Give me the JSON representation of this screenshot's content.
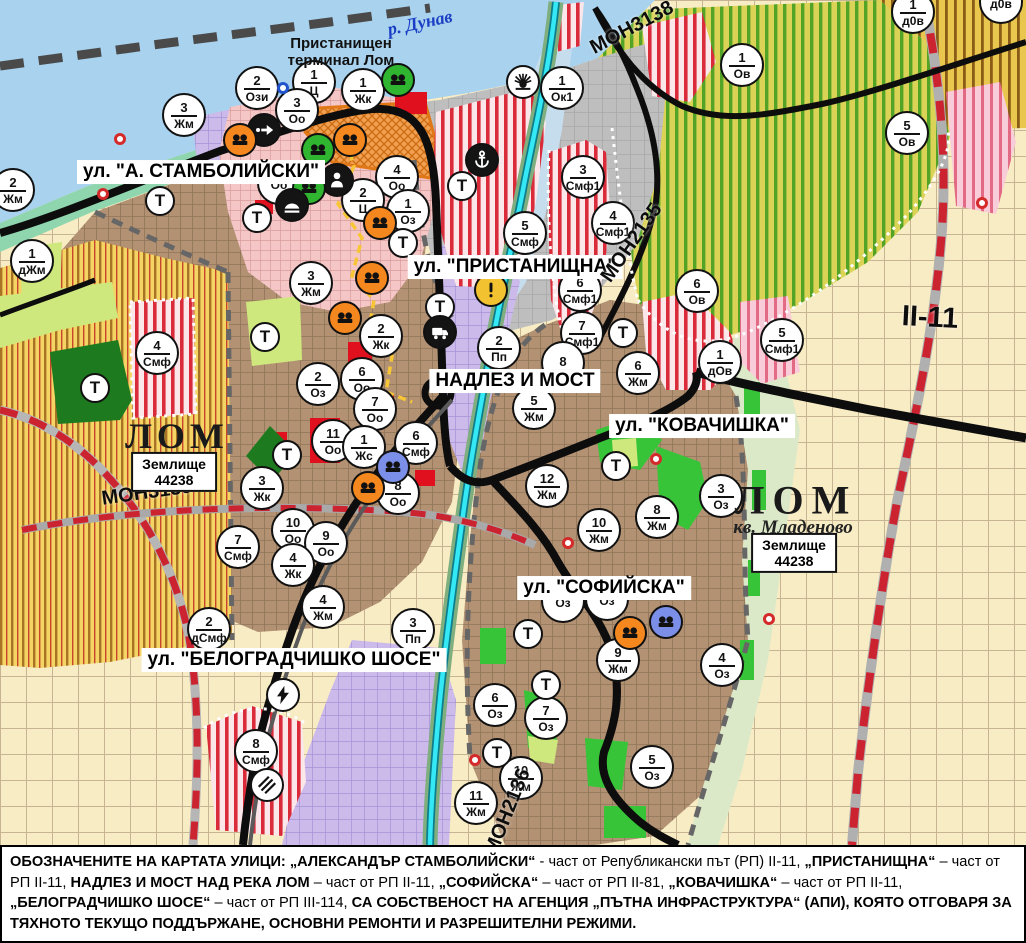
{
  "colors": {
    "orange": "#f5871f",
    "green": "#2fb52f",
    "blue": "#7c8fe8",
    "yellow": "#f2c230",
    "black": "#141414",
    "white": "#ffffff",
    "marker_border": "#111111",
    "red_dot": "#d42a2a",
    "blue_ring": "#2255cc"
  },
  "map": {
    "t_label": "Т",
    "street_labels": [
      {
        "text": "ул. \"А. СТАМБОЛИЙСКИ\"",
        "x": 201,
        "y": 172
      },
      {
        "text": "ул. \"ПРИСТАНИЩНА\"",
        "x": 515,
        "y": 267
      },
      {
        "text": "НАДЛЕЗ И МОСТ",
        "x": 515,
        "y": 381
      },
      {
        "text": "ул. \"КОВАЧИШКА\"",
        "x": 702,
        "y": 426
      },
      {
        "text": "ул. \"СОФИЙСКА\"",
        "x": 604,
        "y": 588
      },
      {
        "text": "ул. \"БЕЛОГРАДЧИШКО ШОСЕ\"",
        "x": 294,
        "y": 660
      }
    ],
    "road_labels": [
      {
        "text": "МОН3139",
        "x": 147,
        "y": 493,
        "rot": -8,
        "size": 20
      },
      {
        "text": "МОН3138",
        "x": 632,
        "y": 28,
        "rot": -28,
        "size": 20
      },
      {
        "text": "МОН2135",
        "x": 632,
        "y": 243,
        "rot": -55,
        "size": 20
      },
      {
        "text": "МОН2136",
        "x": 508,
        "y": 812,
        "rot": -68,
        "size": 20
      },
      {
        "text": "II-11",
        "x": 930,
        "y": 318,
        "rot": 3,
        "size": 29
      }
    ],
    "area_labels": [
      {
        "style": "city",
        "text": "ЛОМ",
        "x": 177,
        "y": 436,
        "size": 36,
        "ls": 5
      },
      {
        "style": "box",
        "text": "Землище\n44238",
        "x": 174,
        "y": 472
      },
      {
        "style": "city",
        "text": "ЛОМ",
        "x": 796,
        "y": 500,
        "size": 40,
        "ls": 8
      },
      {
        "style": "italic",
        "text": "кв. Младеново",
        "x": 793,
        "y": 528,
        "size": 19
      },
      {
        "style": "box",
        "text": "Землище\n44238",
        "x": 794,
        "y": 553
      },
      {
        "style": "river",
        "text": "р. Дунав",
        "x": 420,
        "y": 23
      },
      {
        "style": "port",
        "text": "Пристанищен\nтерминал Лом",
        "x": 341,
        "y": 52
      }
    ],
    "markers": [
      {
        "n": "2",
        "c": "Ози",
        "x": 257,
        "y": 88
      },
      {
        "n": "1",
        "c": "Ц",
        "x": 314,
        "y": 82
      },
      {
        "n": "1",
        "c": "Жк",
        "x": 363,
        "y": 90
      },
      {
        "n": "3",
        "c": "Оо",
        "x": 297,
        "y": 110
      },
      {
        "n": "1",
        "c": "Ок1",
        "x": 562,
        "y": 88
      },
      {
        "n": "3",
        "c": "Жм",
        "x": 184,
        "y": 115
      },
      {
        "n": "",
        "c": "Оо",
        "x": 279,
        "y": 183
      },
      {
        "n": "4",
        "c": "Оо",
        "x": 397,
        "y": 177
      },
      {
        "n": "2",
        "c": "Ц",
        "x": 363,
        "y": 200
      },
      {
        "n": "1",
        "c": "Оз",
        "x": 408,
        "y": 211
      },
      {
        "n": "1",
        "c": "дЖм",
        "x": 32,
        "y": 261
      },
      {
        "n": "2",
        "c": "Жм",
        "x": 13,
        "y": 190
      },
      {
        "n": "3",
        "c": "Жм",
        "x": 311,
        "y": 283
      },
      {
        "n": "2",
        "c": "Жк",
        "x": 381,
        "y": 336
      },
      {
        "n": "6",
        "c": "Оо",
        "x": 362,
        "y": 379
      },
      {
        "n": "2",
        "c": "Оз",
        "x": 318,
        "y": 384
      },
      {
        "n": "7",
        "c": "Оо",
        "x": 375,
        "y": 409
      },
      {
        "n": "11",
        "c": "Оо",
        "x": 333,
        "y": 441
      },
      {
        "n": "1",
        "c": "Жс",
        "x": 364,
        "y": 447
      },
      {
        "n": "6",
        "c": "Смф",
        "x": 416,
        "y": 443
      },
      {
        "n": "8",
        "c": "Оо",
        "x": 398,
        "y": 493
      },
      {
        "n": "3",
        "c": "Жк",
        "x": 262,
        "y": 488
      },
      {
        "n": "10",
        "c": "Оо",
        "x": 293,
        "y": 530
      },
      {
        "n": "9",
        "c": "Оо",
        "x": 326,
        "y": 543
      },
      {
        "n": "4",
        "c": "Жк",
        "x": 293,
        "y": 565
      },
      {
        "n": "7",
        "c": "Смф",
        "x": 238,
        "y": 547
      },
      {
        "n": "4",
        "c": "Смф",
        "x": 157,
        "y": 353
      },
      {
        "n": "2",
        "c": "дСмф",
        "x": 209,
        "y": 629
      },
      {
        "n": "4",
        "c": "Жм",
        "x": 323,
        "y": 607
      },
      {
        "n": "3",
        "c": "Пп",
        "x": 413,
        "y": 630
      },
      {
        "n": "8",
        "c": "Смф",
        "x": 256,
        "y": 751
      },
      {
        "n": "2",
        "c": "Пп",
        "x": 499,
        "y": 348
      },
      {
        "n": "5",
        "c": "Смф",
        "x": 525,
        "y": 233
      },
      {
        "n": "3",
        "c": "Смф1",
        "x": 583,
        "y": 177
      },
      {
        "n": "4",
        "c": "Смф1",
        "x": 613,
        "y": 223
      },
      {
        "n": "6",
        "c": "Смф1",
        "x": 580,
        "y": 290
      },
      {
        "n": "7",
        "c": "Смф1",
        "x": 582,
        "y": 333
      },
      {
        "n": "8",
        "c": "",
        "x": 563,
        "y": 363
      },
      {
        "n": "5",
        "c": "Жм",
        "x": 534,
        "y": 408
      },
      {
        "n": "6",
        "c": "Жм",
        "x": 638,
        "y": 373
      },
      {
        "n": "12",
        "c": "Жм",
        "x": 547,
        "y": 486
      },
      {
        "n": "10",
        "c": "Жм",
        "x": 599,
        "y": 530
      },
      {
        "n": "8",
        "c": "Жм",
        "x": 657,
        "y": 517
      },
      {
        "n": "3",
        "c": "Оз",
        "x": 721,
        "y": 496
      },
      {
        "n": "1",
        "c": "дОв",
        "x": 720,
        "y": 362
      },
      {
        "n": "5",
        "c": "Смф1",
        "x": 782,
        "y": 340
      },
      {
        "n": "6",
        "c": "Ов",
        "x": 697,
        "y": 291
      },
      {
        "n": "1",
        "c": "Ов",
        "x": 742,
        "y": 65
      },
      {
        "n": "5",
        "c": "Ов",
        "x": 907,
        "y": 133
      },
      {
        "n": "1",
        "c": "д0в",
        "x": 913,
        "y": 12
      },
      {
        "n": "",
        "c": "д0в",
        "x": 1001,
        "y": 2
      },
      {
        "n": "9",
        "c": "Жм",
        "x": 618,
        "y": 660
      },
      {
        "n": "4",
        "c": "Оз",
        "x": 722,
        "y": 665
      },
      {
        "n": "6",
        "c": "Оз",
        "x": 495,
        "y": 705
      },
      {
        "n": "7",
        "c": "Оз",
        "x": 546,
        "y": 718
      },
      {
        "n": "5",
        "c": "Оз",
        "x": 652,
        "y": 767
      },
      {
        "n": "10",
        "c": "Жм",
        "x": 521,
        "y": 778
      },
      {
        "n": "11",
        "c": "Жм",
        "x": 476,
        "y": 803
      },
      {
        "n": "",
        "c": "Оз",
        "x": 563,
        "y": 601
      },
      {
        "n": "",
        "c": "Оз",
        "x": 607,
        "y": 599
      }
    ],
    "t_markers": [
      [
        160,
        201
      ],
      [
        257,
        218
      ],
      [
        265,
        337
      ],
      [
        462,
        186
      ],
      [
        403,
        243
      ],
      [
        440,
        307
      ],
      [
        623,
        333
      ],
      [
        287,
        455
      ],
      [
        95,
        388
      ],
      [
        616,
        466
      ],
      [
        528,
        634
      ],
      [
        546,
        685
      ],
      [
        497,
        753
      ]
    ],
    "icons": [
      {
        "t": "ind",
        "bg": "green",
        "x": 398,
        "y": 80
      },
      {
        "t": "sun",
        "bg": "white",
        "x": 523,
        "y": 82
      },
      {
        "t": "oneway",
        "bg": "black",
        "x": 264,
        "y": 130
      },
      {
        "t": "ind",
        "bg": "orange",
        "x": 240,
        "y": 140
      },
      {
        "t": "ind",
        "bg": "orange",
        "x": 350,
        "y": 140
      },
      {
        "t": "ind",
        "bg": "green",
        "x": 318,
        "y": 150
      },
      {
        "t": "person",
        "bg": "black",
        "x": 337,
        "y": 180
      },
      {
        "t": "ind",
        "bg": "green",
        "x": 309,
        "y": 188
      },
      {
        "t": "mound",
        "bg": "black",
        "x": 292,
        "y": 205
      },
      {
        "t": "anchor",
        "bg": "black",
        "x": 482,
        "y": 160
      },
      {
        "t": "ind",
        "bg": "orange",
        "x": 380,
        "y": 223
      },
      {
        "t": "ind",
        "bg": "orange",
        "x": 372,
        "y": 278
      },
      {
        "t": "ind",
        "bg": "orange",
        "x": 345,
        "y": 318
      },
      {
        "t": "excl",
        "bg": "yellow",
        "x": 491,
        "y": 290
      },
      {
        "t": "truck",
        "bg": "black",
        "x": 440,
        "y": 332
      },
      {
        "t": "ind",
        "bg": "blue",
        "x": 393,
        "y": 467
      },
      {
        "t": "ind",
        "bg": "orange",
        "x": 368,
        "y": 488
      },
      {
        "t": "bolt",
        "bg": "white",
        "x": 283,
        "y": 695
      },
      {
        "t": "railx",
        "bg": "white",
        "x": 267,
        "y": 785
      },
      {
        "t": "ind",
        "bg": "orange",
        "x": 630,
        "y": 633
      },
      {
        "t": "ind",
        "bg": "blue",
        "x": 666,
        "y": 622
      }
    ],
    "dots": [
      {
        "x": 120,
        "y": 139,
        "c": "#d42a2a"
      },
      {
        "x": 103,
        "y": 194,
        "c": "#d42a2a"
      },
      {
        "x": 656,
        "y": 459,
        "c": "#d42a2a"
      },
      {
        "x": 568,
        "y": 543,
        "c": "#d42a2a"
      },
      {
        "x": 475,
        "y": 760,
        "c": "#d42a2a"
      },
      {
        "x": 769,
        "y": 619,
        "c": "#d42a2a"
      },
      {
        "x": 982,
        "y": 203,
        "c": "#d42a2a"
      },
      {
        "x": 283,
        "y": 88,
        "c": "#2255cc"
      }
    ]
  },
  "caption": {
    "segments": [
      {
        "b": 1,
        "t": "ОБОЗНАЧЕНИТЕ НА КАРТАТА УЛИЦИ: „АЛЕКСАНДЪР СТАМБОЛИЙСКИ“"
      },
      {
        "b": 0,
        "t": " - част от Републикански път (РП) II-11, "
      },
      {
        "b": 1,
        "t": "„ПРИСТАНИЩНА“"
      },
      {
        "b": 0,
        "t": " – част от РП II-11, "
      },
      {
        "b": 1,
        "t": "НАДЛЕЗ И МОСТ НАД РЕКА ЛОМ"
      },
      {
        "b": 0,
        "t": " – част от РП II-11, "
      },
      {
        "b": 1,
        "t": "„СОФИЙСКА“"
      },
      {
        "b": 0,
        "t": " – част от РП II-81, "
      },
      {
        "b": 1,
        "t": "„КОВАЧИШКА“"
      },
      {
        "b": 0,
        "t": " – част от РП II-11, "
      },
      {
        "b": 1,
        "t": "„БЕЛОГРАДЧИШКО ШОСЕ“"
      },
      {
        "b": 0,
        "t": " – част от РП III-114, "
      },
      {
        "b": 1,
        "t": "СА СОБСТВЕНОСТ НА АГЕНЦИЯ „ПЪТНА ИНФРАСТРУКТУРА“ (АПИ), КОЯТО ОТГОВАРЯ ЗА ТЯХНОТО ТЕКУЩО ПОДДЪРЖАНЕ, ОСНОВНИ РЕМОНТИ И РАЗРЕШИТЕЛНИ РЕЖИМИ."
      }
    ]
  }
}
